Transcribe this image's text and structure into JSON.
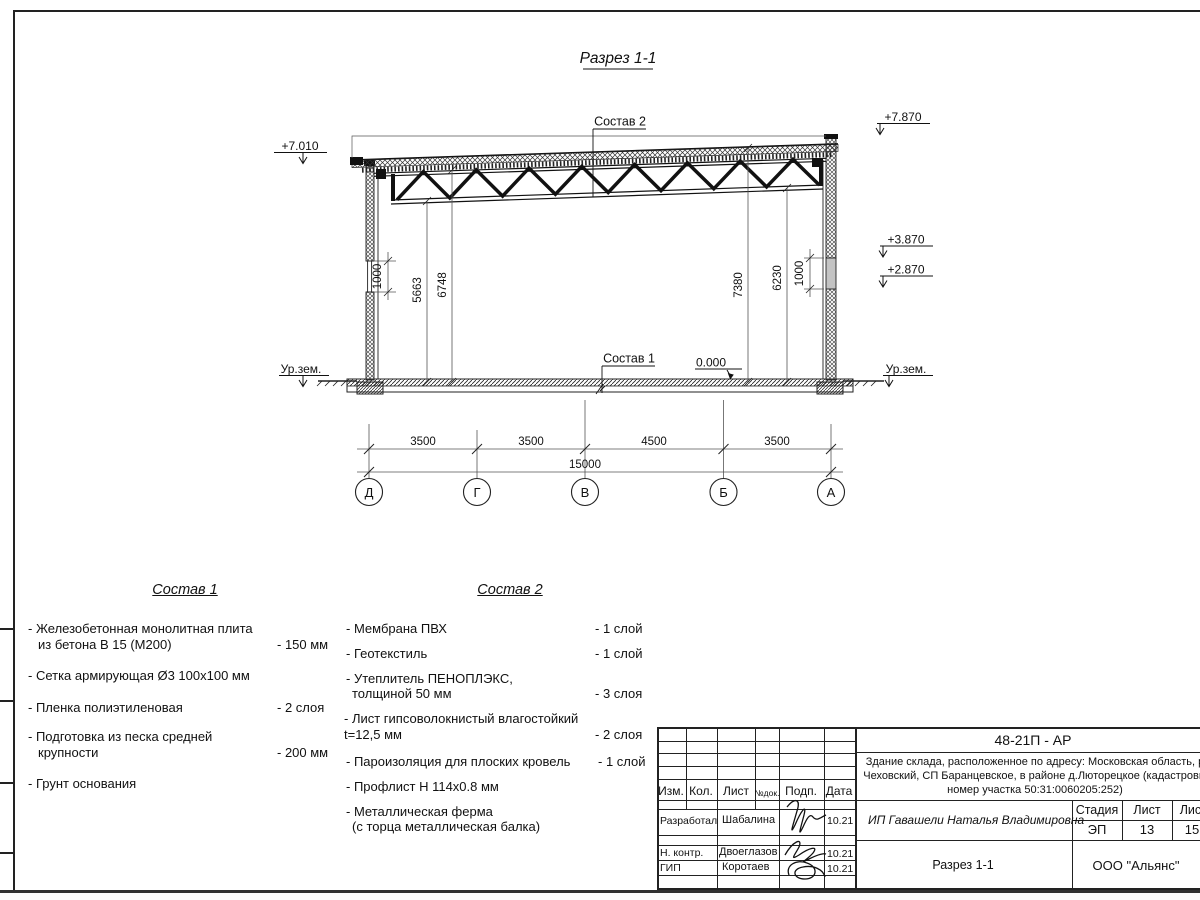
{
  "drawing": {
    "title": "Разрез 1-1",
    "composition1_ref": "Состав 1",
    "composition2_ref": "Состав 2",
    "zero_mark": "0.000",
    "ground_left": "Ур.зем.",
    "ground_right": "Ур.зем.",
    "elev_left_top": "+7.010",
    "elev_right_top": "+7.870",
    "elev_right_upper": "+3.870",
    "elev_right_lower": "+2.870",
    "dim_left_window": "1000",
    "dim_right_window": "1000",
    "dim_height_1": "5663",
    "dim_height_2": "6748",
    "dim_height_3": "7380",
    "dim_height_4": "6230",
    "span_dims": [
      "3500",
      "3500",
      "4500",
      "3500"
    ],
    "total_dim": "15000",
    "axes": [
      "Д",
      "Г",
      "В",
      "Б",
      "А"
    ]
  },
  "composition1": {
    "title": "Состав 1",
    "items": [
      {
        "t": "- Железобетонная  монолитная плита",
        "t2": "из бетона В 15 (М200)",
        "v": "- 150 мм"
      },
      {
        "t": "- Сетка армирующая Ø3 100х100 мм"
      },
      {
        "t": "- Пленка полиэтиленовая",
        "v": "-  2 слоя"
      },
      {
        "t": "- Подготовка из песка средней",
        "t2": "крупности",
        "v": "- 200 мм"
      },
      {
        "t": "- Грунт основания"
      }
    ]
  },
  "composition2": {
    "title": "Состав 2",
    "items": [
      {
        "t": "- Мембрана ПВХ",
        "v": "- 1 слой"
      },
      {
        "t": "- Геотекстиль",
        "v": "- 1 слой"
      },
      {
        "t": "- Утеплитель ПЕНОПЛЭКС,",
        "t2": "толщиной 50 мм",
        "v": "- 3 слоя"
      },
      {
        "t": "- Лист гипсоволокнистый влагостойкий",
        "t2": "t=12,5 мм",
        "v": "- 2 слоя"
      },
      {
        "t": "- Пароизоляция для плоских кровель",
        "v": "- 1 слой"
      },
      {
        "t": "- Профлист Н 114х0.8 мм"
      },
      {
        "t": "- Металлическая ферма",
        "t2": "(с торца металлическая балка)"
      }
    ]
  },
  "titleblock": {
    "code": "48-21П - АР",
    "project_line1": "Здание склада, расположенное по адресу: Московская область, р",
    "project_line2": "Чеховский, СП Баранцевское, в районе д.Люторецкое  (кадастровы",
    "project_line3": "номер участка 50:31:0060205:252)",
    "client": "ИП Гавашели Наталья Владимировна",
    "headers": [
      "Изм.",
      "Кол.",
      "Лист",
      "№док.",
      "Подп.",
      "Дата"
    ],
    "rows": [
      {
        "role": "Разработал",
        "name": "Шабалина",
        "date": "10.21"
      },
      {
        "role": "Н. контр.",
        "name": "Двоеглазов",
        "date": "10.21"
      },
      {
        "role": "ГИП",
        "name": "Коротаев",
        "date": "10.21"
      }
    ],
    "stage_label": "Стадия",
    "sheet_label": "Лист",
    "sheets_label": "Листов",
    "stage": "ЭП",
    "sheet": "13",
    "sheets": "15",
    "drawing_name": "Разрез 1-1",
    "company": "ООО \"Альянс\""
  }
}
